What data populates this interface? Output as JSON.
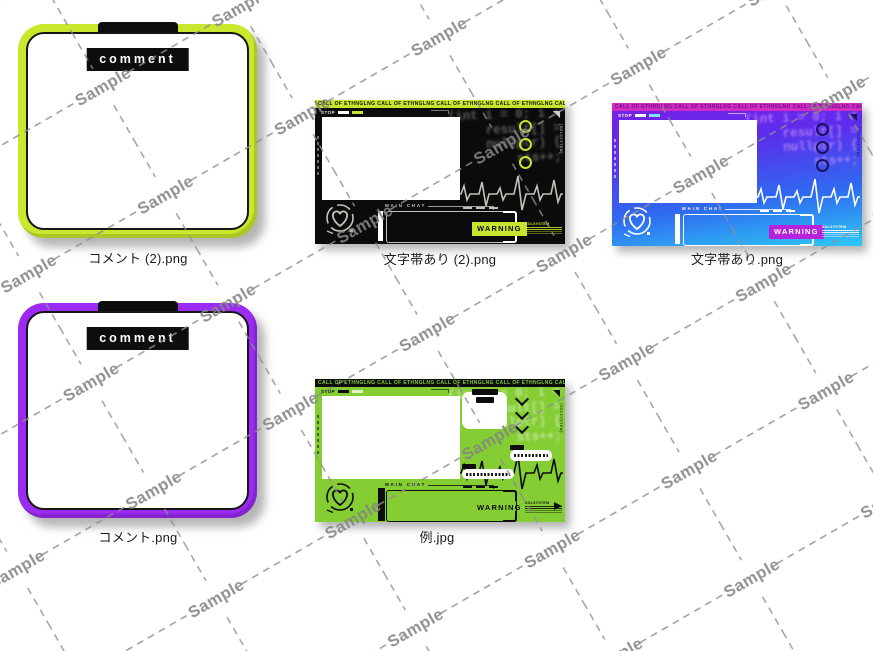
{
  "watermark": {
    "text": "Sample",
    "line_color": "#8f8f8f",
    "text_color": "#858585"
  },
  "items": [
    {
      "filename": "コメント (2).png",
      "type": "comment-frame",
      "theme": "lime"
    },
    {
      "filename": "文字帯あり (2).png",
      "type": "stream-overlay",
      "theme": "dark"
    },
    {
      "filename": "文字帯あり.png",
      "type": "stream-overlay",
      "theme": "blue"
    },
    {
      "filename": "コメント.png",
      "type": "comment-frame",
      "theme": "purple"
    },
    {
      "filename": "例.jpg",
      "type": "stream-overlay-example",
      "theme": "green"
    }
  ],
  "comment_frame": {
    "label": "comment",
    "lime_color": "#c7e82c",
    "purple_color": "#9b2bf2"
  },
  "overlay": {
    "band_text": "CALL OF ETHNGLNG CALL OF ETHNGLNG CALL OF ETHNGLNG CALL OF ETHNGLNG CALL OF ETHNGLNG CALL OF ETHNGLNG CALL OF ETHNGLNG CALL OF ETHNGLNG CALL OF ETHNGLNG CALL OF ETHNGLNG",
    "stop_label": "STOP",
    "main_chat_label": "MAIN CHAT",
    "warning_label": "WARNING",
    "system_label": "[SOLSYSTEM]",
    "side_note": "SOLSYSTEM",
    "code_lines": [
      "(int i = 0; i <",
      "result[] =",
      "nullptr) {",
      "sts++;"
    ]
  },
  "themes": {
    "lime": {
      "frame": "#c7e82c"
    },
    "purple": {
      "frame": "#9b2bf2"
    },
    "dark": {
      "bg": "#0b0b0b",
      "accent": "#c7e52f",
      "art": "#c0c5ba",
      "band-bg": "#c7e52f",
      "band-fg": "#131500",
      "warn-bg": "#c7e52f",
      "warn-fg": "#0b0b0b",
      "ring": "#c7e52f",
      "bar": "#ffffff",
      "code": "rgba(120,120,120,0.72)",
      "chip2": "#c7e52f",
      "stop": "#e6e6e6",
      "note": "#c7e52f",
      "tri": "#cfd3c9"
    },
    "blue": {
      "bg": "linear-gradient(172deg,#7b1fe6 0%,#5c2ceb 30%,#2f6af0 66%,#2ec9f4 100%)",
      "accent": "#d12cc2",
      "art": "#ffffff",
      "band-bg": "#d12cc2",
      "band-fg": "#70108c",
      "warn-bg": "#b722dc",
      "warn-fg": "#ffffff",
      "ring": "#1c1060",
      "bar": "#ffffff",
      "code": "rgba(221,160,255,0.62)",
      "chip2": "#7fe6f7",
      "stop": "#ffffff",
      "note": "#ffffff",
      "tri": "#1c1060"
    },
    "green": {
      "bg": "#84cd33",
      "accent": "#0d0d0d",
      "art": "#0d0d0d",
      "band-bg": "#0d0d0d",
      "band-fg": "#84cd33",
      "warn-bg": "transparent",
      "warn-fg": "#0d0d0d",
      "ring": "#0d0d0d",
      "bar": "#0d0d0d",
      "code": "rgba(255,255,255,0.5)",
      "chip2": "rgba(255,255,255,0.75)",
      "stop": "#0d0d0d",
      "note": "#0d0d0d",
      "tri": "#0d0d0d"
    }
  }
}
